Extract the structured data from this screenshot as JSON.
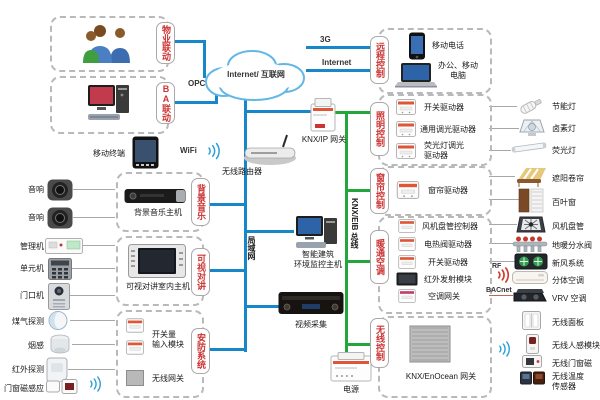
{
  "cloud": {
    "label": "Internet/ 互联网"
  },
  "links": {
    "opc": "OPC",
    "g3": "3G",
    "internet": "Internet",
    "wifi": "WiFi",
    "rf": "RF",
    "bacnet": "BACnet",
    "lan": "局域网",
    "knx_bus": "KNX/EIB 总线"
  },
  "tabs": {
    "property": "物业联动",
    "ba": "BA联动",
    "remote": "远程控制",
    "lighting": "照明控制",
    "curtain": "窗帘控制",
    "hvac": "暖通空调",
    "wireless": "无线控制",
    "music": "背景音乐",
    "intercom": "可视对讲",
    "security": "安防系统"
  },
  "remote_box": {
    "phone": "移动电话",
    "pc": "办公、移动\n电脑"
  },
  "lighting_box": {
    "switch_driver": "开关驱动器",
    "dim_driver": "通用调光驱动器",
    "fl_dim_driver": "荧光灯调光\n驱动器"
  },
  "curtain_box": {
    "curtain_driver": "窗帘驱动器"
  },
  "hvac_box": {
    "fancoil_ctrl": "风机盘管控制器",
    "valve_driver": "电热阀驱动器",
    "switch_driver": "开关驱动器",
    "ir_module": "红外发射模块",
    "ac_gateway": "空调网关"
  },
  "wireless_box": {
    "enocean_gw": "KNX/EnOcean 网关"
  },
  "music_box": {
    "host": "背景音乐主机"
  },
  "intercom_box": {
    "host": "可视对讲室内主机"
  },
  "security_box": {
    "di_module": "开关量\n输入模块",
    "wireless_gw": "无线网关"
  },
  "mid": {
    "mobile_terminal": "移动终端",
    "router": "无线路由器",
    "knx_ip_gw": "KNX/IP 网关",
    "building_host": "智能建筑\n环境监控主机",
    "video_capture": "视频采集",
    "power": "电源"
  },
  "left_devices": [
    "音响",
    "音响",
    "管理机",
    "单元机",
    "门口机",
    "煤气探测",
    "烟感",
    "红外探测",
    "门窗磁感应"
  ],
  "right_devices": [
    "节能灯",
    "卤素灯",
    "荧光灯",
    "遮阳卷帘",
    "百叶窗",
    "风机盘管",
    "地暖分水阀",
    "新风系统",
    "分体空调",
    "VRV 空调"
  ],
  "wireless_devices": [
    "无线面板",
    "无线人感模块",
    "无线门窗磁",
    "无线温度\n传感器"
  ],
  "colors": {
    "line_blue": "#1787c9",
    "line_green": "#23a63b",
    "tab_red": "#cc3333"
  }
}
